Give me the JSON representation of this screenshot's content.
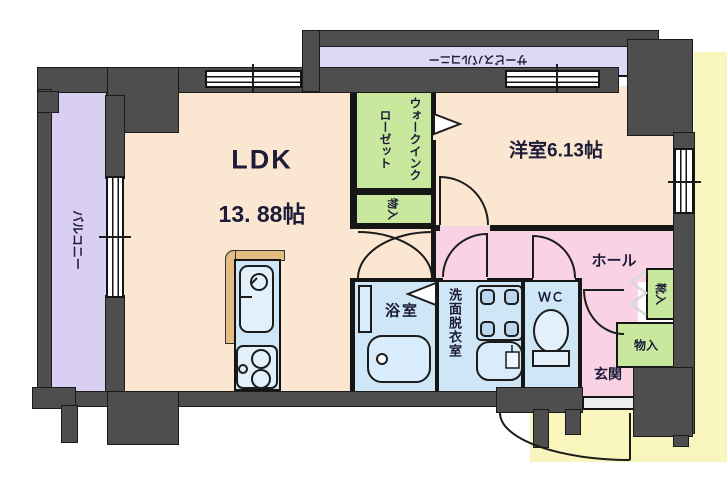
{
  "rooms": {
    "ldk": {
      "label": "LDK",
      "area": "13. 88帖"
    },
    "western_room": {
      "label": "洋室6.13帖"
    },
    "balcony": {
      "label": "バルコニー"
    },
    "service_balcony": {
      "label": "サービスバルコニー"
    },
    "walk_in_closet": {
      "label": "ウォークインクローゼット"
    },
    "wic_storage": {
      "label": "物入"
    },
    "bathroom": {
      "label": "浴室"
    },
    "washroom": {
      "label": "洗面脱衣室"
    },
    "wc": {
      "label": "ＷＣ"
    },
    "hall": {
      "label": "ホール"
    },
    "entrance": {
      "label": "玄関"
    },
    "shoe_storage": {
      "label": "靴入"
    },
    "entry_storage": {
      "label": "物入"
    }
  },
  "colors": {
    "wall": "#4e4e4e",
    "room_peach": "#fbe7d1",
    "balcony_purple": "#d8cff2",
    "closet_green": "#c8e89e",
    "hall_pink": "#f9d2e4",
    "wet_blue": "#cfe6f7",
    "exterior_yellow": "#f8f5bd",
    "counter_tan": "#e3bc82",
    "text": "#1c1c38"
  }
}
